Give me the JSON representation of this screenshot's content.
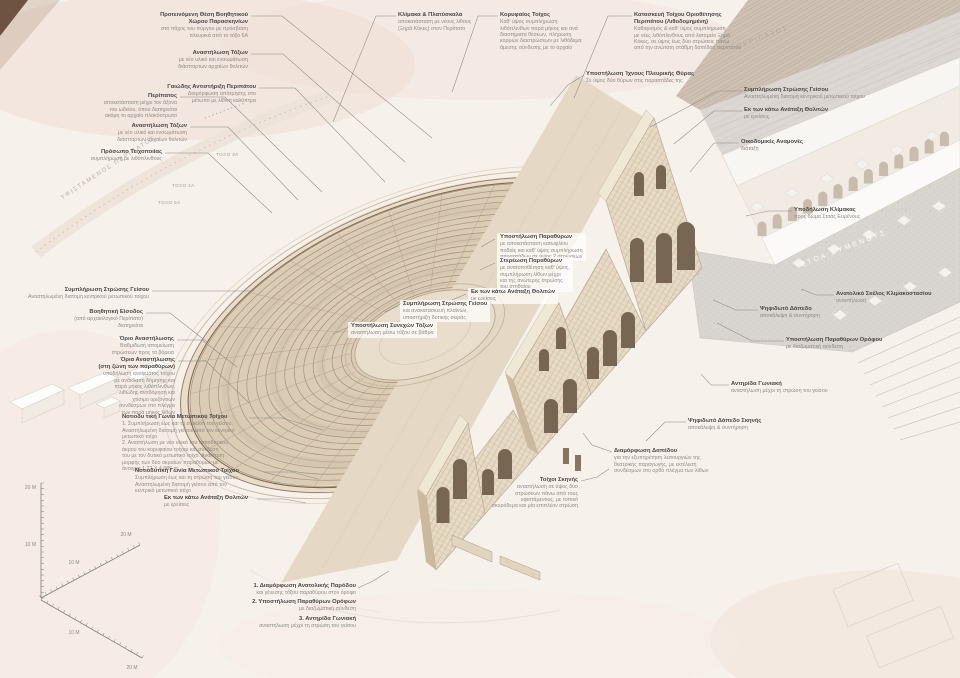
{
  "colors": {
    "background": "#f7f1ec",
    "stone_light": "#e7dbc5",
    "stone_mid": "#dbccb6",
    "stone_line": "#a5907a",
    "opening_dark": "#6d5c49",
    "road_gray": "#ddd8d3",
    "floor_gray": "#d9d5d0",
    "pink_wash": "#f0ddd4",
    "label_title": "#474543",
    "label_sub": "#8f8b87",
    "leader": "#8a8a8a"
  },
  "drawing_labels": {
    "existing_peripatos": "ΥΦΙΣΤΑΜΕΝΟΣ ΠΕΡΙΠΑΤΟΣ",
    "peripatos_road": "ΠΕΡΙΠΑΤΟΣ",
    "peripatos_road_sub": "υφιστάμενη χάραξη",
    "stoa_eumenous": "ΣΤΟΑ ΕΥΜΕΝΟΥΣ",
    "arch_tags": [
      "ΤΟΞΟ 3Α",
      "ΤΟΞΟ 4Α",
      "ΤΟΞΟ 5Α"
    ]
  },
  "scale_axes": {
    "vertical": [
      "20 M",
      "10 M"
    ],
    "upper_diagonal": [
      "20 M",
      "10 M"
    ],
    "lower_diagonal": [
      "10 M",
      "20 M"
    ]
  },
  "legend": {
    "items": [
      {
        "title": "1. Διαμόρφωση Ανατολικής Παρόδου",
        "sub": "και γένεσης τόξου παραθύρου στον όροφο"
      },
      {
        "title": "2. Υποστήλωση Παραθύρων Ορόφων",
        "sub": "με διαζωματική σύνδεση"
      },
      {
        "title": "3. Αντηρίδα Γωνιακή",
        "sub": "αναστήλωση μέχρι τη στρώση του γείσου"
      }
    ],
    "leader": [
      [
        358,
        588
      ],
      [
        373,
        581
      ],
      [
        389,
        571
      ]
    ]
  },
  "annotations": [
    {
      "id": "backstage-area",
      "x": 248,
      "y": 12,
      "align": "right",
      "bg": false,
      "title": [
        "Προτεινόμενη Θέση Βοηθητικού",
        "Χώρου Παρασκηνίων"
      ],
      "sub": [
        "στο πάχος του πύργου με πρόσβαση",
        "πλευρικά από το τόξο 6Α"
      ],
      "leader": [
        [
          251,
          16
        ],
        [
          282,
          16
        ],
        [
          432,
          138
        ]
      ]
    },
    {
      "id": "arch-restoration-north",
      "x": 248,
      "y": 50,
      "align": "right",
      "bg": false,
      "title": [
        "Αναστήλωση Τόξων"
      ],
      "sub": [
        "με νέο υλικό και ενσωμάτωση",
        "διάσπαρτων αρχαίων θολιτών"
      ],
      "leader": [
        [
          251,
          54
        ],
        [
          283,
          54
        ],
        [
          405,
          162
        ]
      ]
    },
    {
      "id": "peripatos-retaining",
      "x": 256,
      "y": 84,
      "align": "right",
      "bg": false,
      "title": [
        "Γαιώδης Αντιστήριξη Περιπάτου"
      ],
      "sub": [
        "Διαμόρφωση απότμησης στο",
        "μέτωπο με λίθινη καλύπτρα"
      ],
      "leader": [
        [
          259,
          88
        ],
        [
          295,
          88
        ],
        [
          385,
          182
        ]
      ]
    },
    {
      "id": "peripatos",
      "x": 177,
      "y": 93,
      "align": "right",
      "bg": false,
      "title": [
        "Περίπατος"
      ],
      "sub": [
        "αποκατάσταση μέχρι τον άξονα",
        "του ωδείου, όπου διατηρείται",
        "ακόμη το αρχαίο πλακόστρωτο"
      ],
      "leader": [
        [
          180,
          97
        ],
        [
          225,
          97
        ],
        [
          322,
          192
        ]
      ]
    },
    {
      "id": "arch-restoration-west",
      "x": 187,
      "y": 123,
      "align": "right",
      "bg": false,
      "title": [
        "Αναστήλωση Τόξων"
      ],
      "sub": [
        "με νέο υλικό και ενσωμάτωση",
        "διάσπαρτων αρχαίων θολιτών"
      ],
      "leader": [
        [
          190,
          127
        ],
        [
          228,
          127
        ],
        [
          298,
          200
        ]
      ]
    },
    {
      "id": "masonry-face",
      "x": 162,
      "y": 149,
      "align": "right",
      "bg": false,
      "title": [
        "Πρόσωπο Τειχοποιίας"
      ],
      "sub": [
        "συμπλήρωση με λιθόπλινθους"
      ],
      "leader": [
        [
          165,
          153
        ],
        [
          208,
          153
        ],
        [
          272,
          213
        ]
      ]
    },
    {
      "id": "stair-landings",
      "x": 398,
      "y": 12,
      "align": "left",
      "bg": false,
      "title": [
        "Κλίμακα & Πλατύσκαλα"
      ],
      "sub": [
        "αποκατάσταση με νέους λίθους",
        "(Ξηρά Κόκες) στον Περίπατο"
      ],
      "leader": [
        [
          396,
          16
        ],
        [
          376,
          16
        ],
        [
          333,
          122
        ]
      ]
    },
    {
      "id": "crown-wall",
      "x": 500,
      "y": 12,
      "align": "left",
      "bg": false,
      "title": [
        "Κορυφαίος Τοίχος"
      ],
      "sub": [
        "Καθ' ύψος συμπλήρωση",
        "λιθόπλινθων παρά μήκος και ανά",
        "διαστήματα θέσεων, πλήρωση",
        "κορμών διαστρώσεων με λιθόδεμα",
        "άμεσης σύνδεσης με το αρχαίο"
      ],
      "leader": [
        [
          498,
          16
        ],
        [
          478,
          16
        ],
        [
          452,
          92
        ]
      ]
    },
    {
      "id": "boundary-wall",
      "x": 634,
      "y": 12,
      "align": "left",
      "bg": false,
      "title": [
        "Κατασκευή Τοίχου Οριοθέτησης",
        "Περιπάτου (Λιθοδομημένη)"
      ],
      "sub": [
        "Καθαρισμός & καθ' ύψος συμπλήρωση",
        "με νέες λιθόπλινθους από λατομείο Ξηρά",
        "Κόκες, σε ύψος έως δύο στρώσεις πάνω",
        "από την ανώτατη στάθμη δαπέδου περιπάτου"
      ],
      "leader": [
        [
          632,
          16
        ],
        [
          608,
          16
        ],
        [
          574,
          98
        ]
      ]
    },
    {
      "id": "side-door-shoring",
      "x": 586,
      "y": 71,
      "align": "left",
      "bg": false,
      "title": [
        "Υποστήλωση Ίχνους Πλευρικής Θύρας"
      ],
      "sub": [
        "Σε ύψος δύο θύρων στις παραστάδες της"
      ],
      "leader": [
        [
          584,
          75
        ],
        [
          568,
          85
        ],
        [
          550,
          106
        ]
      ]
    },
    {
      "id": "cornice-course-right",
      "x": 744,
      "y": 87,
      "align": "left",
      "bg": false,
      "title": [
        "Συμπλήρωση Στρώσης Γείσου"
      ],
      "sub": [
        "Αναστηλωμένη διατομή κεντρικού μετωπικού τοίχου"
      ],
      "leader": [
        [
          742,
          91
        ],
        [
          718,
          91
        ],
        [
          650,
          127
        ]
      ]
    },
    {
      "id": "vault-realignment-right",
      "x": 744,
      "y": 107,
      "align": "left",
      "bg": false,
      "title": [
        "Εκ των κάτω Ανάταξη Θολιτών"
      ],
      "sub": [
        "με ερείσεις"
      ],
      "leader": [
        [
          742,
          111
        ],
        [
          714,
          111
        ],
        [
          674,
          144
        ]
      ]
    },
    {
      "id": "building-remains",
      "x": 741,
      "y": 139,
      "align": "left",
      "bg": false,
      "title": [
        "Οικοδομικές Αναμονές"
      ],
      "sub": [
        "διάταξη"
      ],
      "leader": [
        [
          739,
          143
        ],
        [
          714,
          143
        ],
        [
          690,
          172
        ]
      ]
    },
    {
      "id": "stoa-stair-marking",
      "x": 794,
      "y": 207,
      "align": "left",
      "bg": false,
      "title": [
        "Υποδήλωση Κλίμακας"
      ],
      "sub": [
        "προς δώμα Στοάς Ευμένους"
      ],
      "leader": [
        [
          792,
          211
        ],
        [
          768,
          211
        ],
        [
          746,
          216
        ]
      ]
    },
    {
      "id": "east-stair-flight",
      "x": 836,
      "y": 291,
      "align": "left",
      "bg": false,
      "title": [
        "Ανατολικό Σκέλος Κλιμακοστασίου"
      ],
      "sub": [
        "αναστήλωση"
      ],
      "leader": [
        [
          834,
          295
        ],
        [
          816,
          295
        ],
        [
          801,
          289
        ]
      ]
    },
    {
      "id": "mosaic-floor",
      "x": 760,
      "y": 306,
      "align": "left",
      "bg": false,
      "title": [
        "Ψηφιδωτό Δάπεδο"
      ],
      "sub": [
        "αποκάλυψη & συντήρηση"
      ],
      "leader": [
        [
          758,
          310
        ],
        [
          736,
          310
        ],
        [
          713,
          300
        ]
      ]
    },
    {
      "id": "upper-window-shoring",
      "x": 786,
      "y": 337,
      "align": "left",
      "bg": false,
      "title": [
        "Υποστήλωση Παραθύρων Ορόφου"
      ],
      "sub": [
        "με διαζωματική σύνδεση"
      ],
      "leader": [
        [
          784,
          341
        ],
        [
          752,
          341
        ],
        [
          717,
          323
        ]
      ]
    },
    {
      "id": "corner-buttress",
      "x": 731,
      "y": 381,
      "align": "left",
      "bg": false,
      "title": [
        "Αντηρίδα Γωνιακή"
      ],
      "sub": [
        "αναστήλωση μέχρι τη στρώση του γείσου"
      ],
      "leader": [
        [
          729,
          385
        ],
        [
          711,
          385
        ],
        [
          701,
          374
        ]
      ]
    },
    {
      "id": "stage-mosaic-floor",
      "x": 688,
      "y": 418,
      "align": "left",
      "bg": false,
      "title": [
        "Ψηφιδωτό Δάπεδο Σκηνής"
      ],
      "sub": [
        "αποκάλυψη & συντήρηση"
      ],
      "leader": [
        [
          686,
          422
        ],
        [
          665,
          422
        ],
        [
          646,
          441
        ]
      ]
    },
    {
      "id": "floor-arrangement",
      "x": 614,
      "y": 448,
      "align": "left",
      "bg": false,
      "title": [
        "Διαμόρφωση Δαπέδου"
      ],
      "sub": [
        "για την εξυπηρέτηση λειτουργιών της",
        "θεατρικής παραγωγής, με εκτέλεση",
        "συνδέσμων στο ορθό πλέγμα των λίθων"
      ],
      "leader": [
        [
          612,
          452
        ],
        [
          592,
          445
        ],
        [
          583,
          433
        ]
      ]
    },
    {
      "id": "stage-walls",
      "x": 578,
      "y": 477,
      "align": "right",
      "bg": false,
      "title": [
        "Τοίχοι Σκηνής"
      ],
      "sub": [
        "αναστήλωση σε ύψος δύο",
        "στρώσεων πάνω από τους",
        "υφιστάμενους, με τοπικό",
        "σκυρόδεμα και μία επιπλέον στρώση"
      ],
      "leader": [
        [
          581,
          481
        ],
        [
          597,
          477
        ],
        [
          609,
          469
        ]
      ]
    },
    {
      "id": "window-shoring",
      "x": 497,
      "y": 233,
      "align": "left",
      "bg": true,
      "title": [
        "Υποστήλωση Παραθύρων"
      ],
      "sub": [
        "με αποκατάσταση κατωφλίου",
        "ποδιάς και καθ' ύψος συμπλήρωση",
        "παραστάδων σε ύψος 2 στρώσεων"
      ],
      "leader": [
        [
          495,
          239
        ],
        [
          481,
          247
        ]
      ]
    },
    {
      "id": "window-fixing",
      "x": 497,
      "y": 257,
      "align": "left",
      "bg": true,
      "title": [
        "Στερέωση Παραθύρων"
      ],
      "sub": [
        "με ανατοποθέτηση καθ' ύψος,",
        "συμπλήρωση λίθων μέχρι",
        "και της ανώτερης στρώσης",
        "του στηθαίου"
      ],
      "leader": [
        [
          495,
          263
        ],
        [
          480,
          270
        ]
      ]
    },
    {
      "id": "vault-realignment-center",
      "x": 468,
      "y": 288,
      "align": "left",
      "bg": true,
      "title": [
        "Εκ των κάτω Ανάταξη Θολιτών"
      ],
      "sub": [
        "με ερείσεις"
      ],
      "leader": [
        [
          466,
          294
        ],
        [
          452,
          300
        ]
      ]
    },
    {
      "id": "cornice-course-center",
      "x": 400,
      "y": 300,
      "align": "left",
      "bg": true,
      "title": [
        "Συμπλήρωση Στρώσης Γείσου"
      ],
      "sub": [
        "και ανακατασκευή πλαϊνών,",
        "υποστήριξη δυτικής σειράς"
      ],
      "leader": [
        [
          398,
          306
        ],
        [
          385,
          312
        ]
      ]
    },
    {
      "id": "continuous-arch-shoring",
      "x": 348,
      "y": 322,
      "align": "left",
      "bg": true,
      "title": [
        "Υποστήλωση Συνεχών Τόξων"
      ],
      "sub": [
        "αναστήλωση μέσω τόξου σε βάθρα"
      ],
      "leader": [
        [
          346,
          328
        ],
        [
          333,
          334
        ]
      ]
    },
    {
      "id": "cornice-course-left",
      "x": 149,
      "y": 287,
      "align": "right",
      "bg": false,
      "title": [
        "Συμπλήρωση Στρώσης Γείσου"
      ],
      "sub": [
        "Αναστηλωμένη διατομή κεντρικού μετωπικού τοίχου"
      ],
      "leader": [
        [
          152,
          291
        ],
        [
          205,
          291
        ],
        [
          254,
          291
        ]
      ]
    },
    {
      "id": "auxiliary-entrance",
      "x": 143,
      "y": 309,
      "align": "right",
      "bg": false,
      "title": [
        "Βοηθητική Είσοδος"
      ],
      "sub": [
        "(από αρχαιολογικό Περίπατο)",
        "διατηρείται"
      ],
      "leader": [
        [
          146,
          313
        ],
        [
          170,
          313
        ],
        [
          207,
          342
        ]
      ]
    },
    {
      "id": "restoration-limit",
      "x": 174,
      "y": 336,
      "align": "right",
      "bg": false,
      "title": [
        "Όριο Αναστήλωσης"
      ],
      "sub": [
        "Βαθμιδωτή απομείωση",
        "στρώσεων προς τα βόρεια"
      ],
      "leader": [
        [
          177,
          340
        ],
        [
          202,
          340
        ],
        [
          237,
          367
        ]
      ]
    },
    {
      "id": "restoration-limits-windows",
      "x": 175,
      "y": 357,
      "align": "right",
      "bg": false,
      "title": [
        "Όρια Αναστήλωσης",
        "(στη ζώνη των παραθύρων)"
      ],
      "sub": [
        "υποδήλωση ανοίγματος τοίχου",
        "με ανάκλαση δόμησης και",
        "παρά μήκος λιθόπλινθων,",
        "λιθώδης αναδόμηση και",
        "χτίσιμο οριζόντιων",
        "συνδέσμων στο πλέγμα",
        "των παρά μήκος λίθων"
      ],
      "leader": [
        [
          178,
          361
        ],
        [
          206,
          361
        ],
        [
          249,
          403
        ]
      ]
    },
    {
      "id": "sw-corner-main",
      "x": 122,
      "y": 414,
      "align": "left",
      "bg": false,
      "title": [
        "Νοτιοδυ τική Γωνία Μετωπικού Τοίχου"
      ],
      "sub": [
        "1. Συμπλήρωση έως και τη στρώση του γείσου,",
        "Αναστηλωμένη διατομή γείσου από τον κεντρικό",
        "μετωπικό τοίχο",
        "2. Αναστήλωση με νέο υλικό του νοτιοδυτικού",
        "άκρου του κορυφαίου τοίχου και σύνδεση",
        "του με τον δυτικό μετωπικό τοίχο. Ανάκτηση",
        "μορφής των δύο ακραίων παραθύρων με",
        "άνοιγμα 1.77 X 4.885 m"
      ],
      "leader": [
        [
          249,
          418
        ],
        [
          282,
          418
        ],
        [
          323,
          430
        ]
      ]
    },
    {
      "id": "sw-corner-south",
      "x": 135,
      "y": 468,
      "align": "left",
      "bg": false,
      "title": [
        "Νοτιοδυτική Γωνία Μετωπικού Τοίχου"
      ],
      "sub": [
        "Συμπλήρωση έως και τη στρώση του γείσου,",
        "Αναστηλωμένη διατομή γείσου από τον",
        "κεντρικό μετωπικό τοίχο"
      ],
      "leader": [
        [
          263,
          472
        ],
        [
          292,
          472
        ],
        [
          318,
          479
        ]
      ]
    },
    {
      "id": "vault-realignment-south",
      "x": 164,
      "y": 495,
      "align": "left",
      "bg": false,
      "title": [
        "Εκ των κάτω Ανάταξη Θολιτών"
      ],
      "sub": [
        "με ερείσεις"
      ],
      "leader": [
        [
          257,
          499
        ],
        [
          284,
          499
        ],
        [
          306,
          503
        ]
      ]
    }
  ]
}
